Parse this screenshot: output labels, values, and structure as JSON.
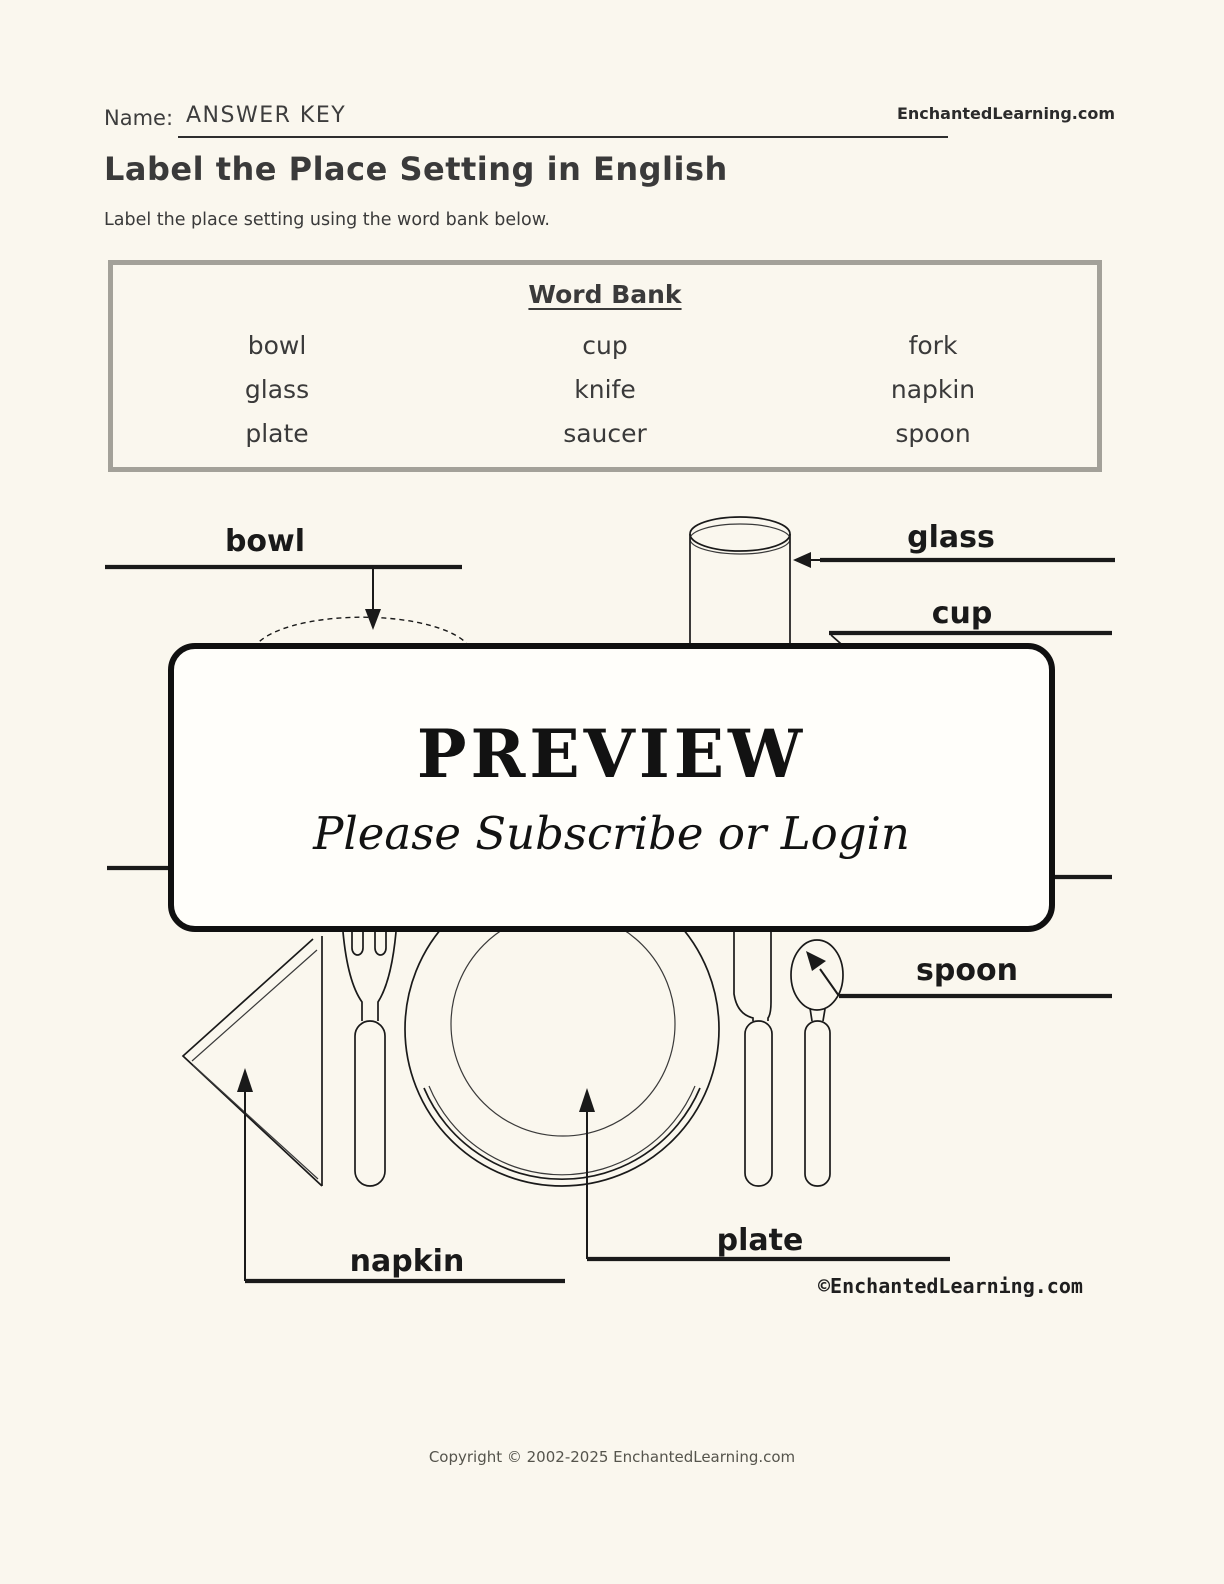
{
  "header": {
    "name_label": "Name:",
    "name_value": "ANSWER KEY",
    "brand": "EnchantedLearning.com",
    "title": "Label the Place Setting in English",
    "instructions": "Label the place setting using the word bank below."
  },
  "word_bank": {
    "title": "Word Bank",
    "rows": [
      [
        "bowl",
        "cup",
        "fork"
      ],
      [
        "glass",
        "knife",
        "napkin"
      ],
      [
        "plate",
        "saucer",
        "spoon"
      ]
    ]
  },
  "diagram": {
    "labels": {
      "bowl": "bowl",
      "glass": "glass",
      "cup": "cup",
      "spoon": "spoon",
      "plate": "plate",
      "napkin": "napkin"
    },
    "watermark": "©EnchantedLearning.com"
  },
  "preview_overlay": {
    "title": "PREVIEW",
    "subtitle": "Please Subscribe or Login"
  },
  "footer": {
    "copyright": "Copyright © 2002-2025 EnchantedLearning.com"
  },
  "colors": {
    "background": "#faf7ee",
    "ink": "#1a1a1a",
    "text": "#3b3b3b",
    "word_bank_border": "#a3a199",
    "preview_fill": "#fffefa"
  }
}
